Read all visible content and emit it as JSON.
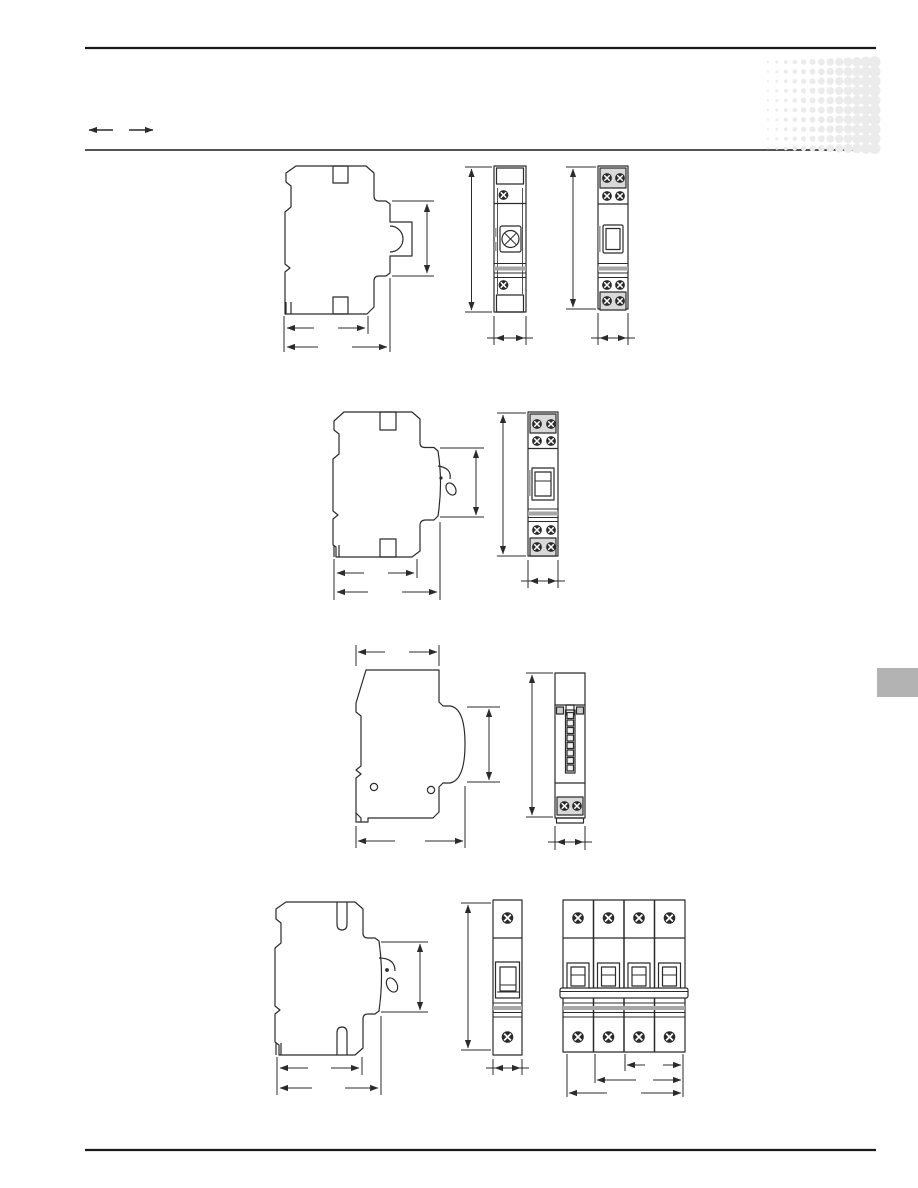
{
  "page": {
    "width": 918,
    "height": 1188,
    "background": "#ffffff"
  },
  "colors": {
    "rule": "#1a1a1a",
    "line": "#2b2b2b",
    "terminal_fill": "#d9d9d9",
    "stripe_band": "#a6a6a6",
    "halftone_dot": "#ebebeb",
    "side_tab": "#b3b3b3",
    "tick": "#9a9a9a",
    "window_cell": "#f0f0f0"
  },
  "header": {
    "icons": [
      "dimension-arrow-left-icon",
      "dimension-arrow-right-icon"
    ]
  },
  "halftone": {
    "rows": 10,
    "cols": 13,
    "x": 768,
    "y": 62,
    "dx": 8.9,
    "dy": 9.6,
    "r_min": 1.1,
    "r_max": 5.7
  },
  "figures": [
    {
      "row": 1,
      "views": [
        "side-profile",
        "front-indicator-module",
        "front-switch-module"
      ]
    },
    {
      "row": 2,
      "views": [
        "side-profile-with-toggle",
        "front-rocker-module"
      ]
    },
    {
      "row": 3,
      "views": [
        "side-profile-rounded",
        "front-strip-module"
      ]
    },
    {
      "row": 4,
      "views": [
        "side-profile-with-toggle",
        "front-breaker-1pole",
        "front-breaker-4pole"
      ]
    }
  ]
}
